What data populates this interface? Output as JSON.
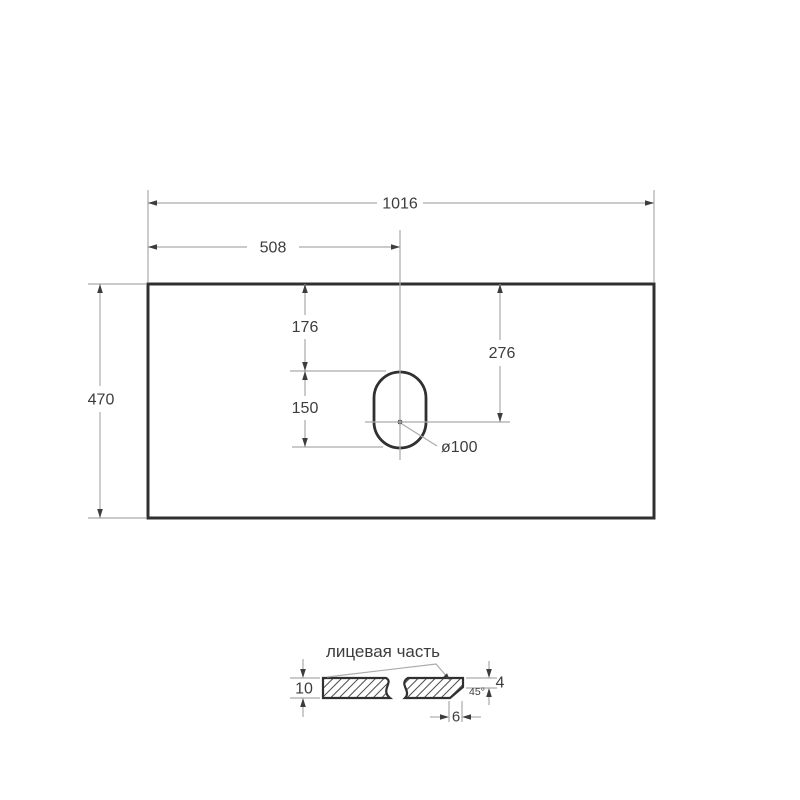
{
  "colors": {
    "outline": "#303030",
    "dimension_lines": "#ababab",
    "text": "#3d3d3d",
    "hatch": "#4f4f4f",
    "background": "#ffffff"
  },
  "top_view": {
    "dim_width": "1016",
    "dim_half_width": "508",
    "dim_height": "470",
    "dim_hole_top_offset": "176",
    "dim_hole_height": "150",
    "dim_hole_center_offset": "276",
    "dim_hole_diameter": "ø100"
  },
  "section_view": {
    "face_label": "лицевая часть",
    "dim_thickness": "10",
    "dim_edge_height": "4",
    "chamfer_angle": "45°",
    "dim_chamfer_width": "6"
  }
}
